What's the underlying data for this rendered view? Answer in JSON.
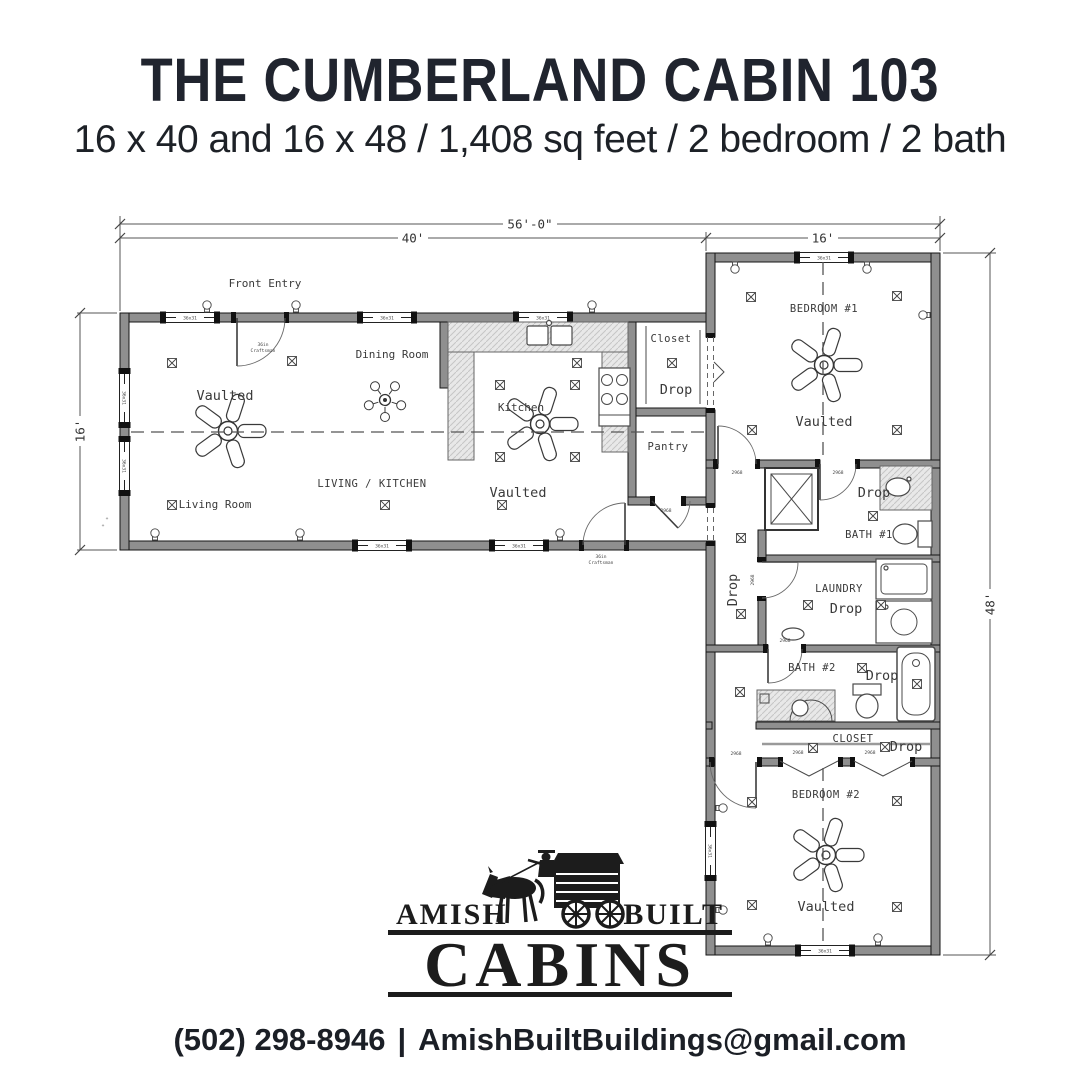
{
  "header": {
    "title": "THE CUMBERLAND CABIN 103",
    "subtitle": "16 x 40 and 16 x 48 / 1,408 sq feet / 2 bedroom / 2 bath"
  },
  "floor_plan": {
    "dimensions": {
      "overall_width": "56'-0\"",
      "left_wing_width": "40'",
      "right_wing_width": "16'",
      "left_wing_depth": "16'",
      "right_wing_height": "48'"
    },
    "labels": {
      "front_entry": "Front Entry",
      "dining_room": "Dining Room",
      "kitchen": "Kitchen",
      "living_kitchen": "LIVING / KITCHEN",
      "living_room": "Living Room",
      "vaulted": "Vaulted",
      "closet": "Closet",
      "drop": "Drop",
      "pantry": "Pantry",
      "bedroom1": "BEDROOM #1",
      "bath1": "BATH #1",
      "laundry": "LAUNDRY",
      "bath2": "BATH #2",
      "closet2": "CLOSET",
      "bedroom2": "BEDROOM #2"
    },
    "tiny_labels": {
      "window": "36x31",
      "door": "2968",
      "entry1": "36in",
      "entry2": "Craftsman"
    }
  },
  "logo": {
    "amish": "AMISH",
    "built": "BUILT",
    "cabins": "CABINS"
  },
  "footer": {
    "phone": "(502) 298-8946",
    "divider": "|",
    "email": "AmishBuiltBuildings@gmail.com"
  },
  "colors": {
    "ink": "#20242e",
    "wall_gray": "#8f8f8f"
  }
}
